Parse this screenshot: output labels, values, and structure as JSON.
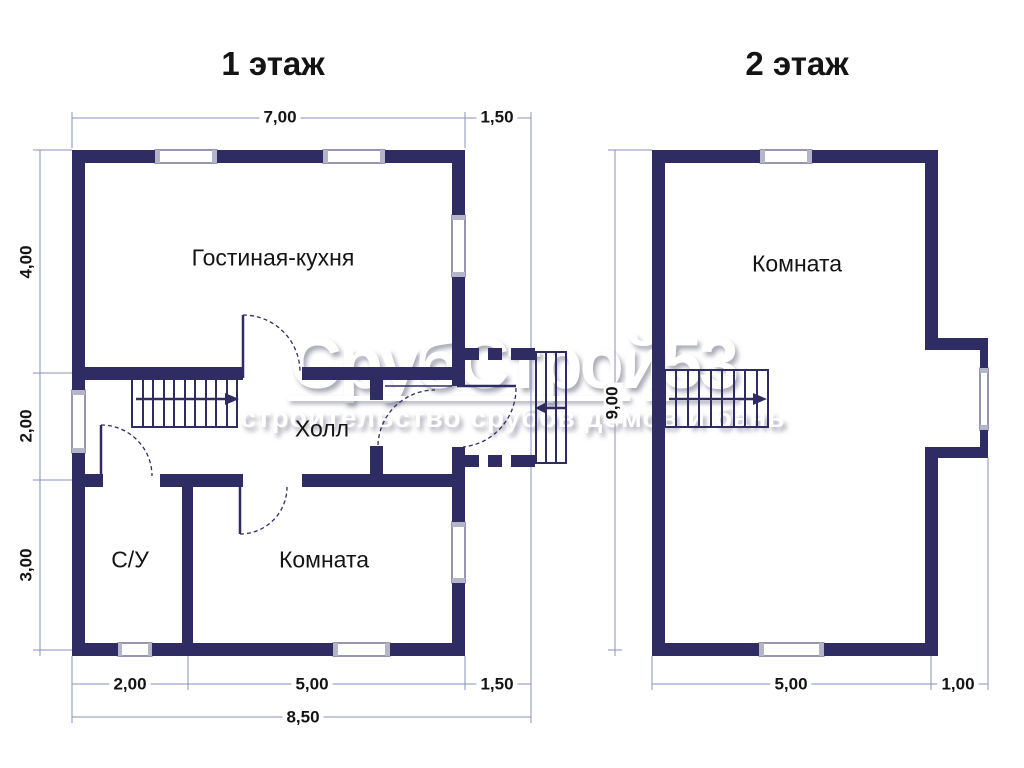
{
  "colors": {
    "wall": "#2f2b63",
    "dim": "#8a90bd",
    "text": "#141414",
    "window_cap": "#b5b5c8",
    "watermark": "#ffffff"
  },
  "floor1": {
    "title": "1 этаж",
    "rooms": {
      "living": "Гостиная-кухня",
      "hall": "Холл",
      "bathroom": "С/У",
      "room": "Комната"
    },
    "dims": {
      "top_main": "7,00",
      "top_porch": "1,50",
      "left_top": "4,00",
      "left_mid": "2,00",
      "left_bottom": "3,00",
      "bottom_left": "2,00",
      "bottom_mid": "5,00",
      "bottom_right": "1,50",
      "bottom_total": "8,50"
    }
  },
  "floor2": {
    "title": "2 этаж",
    "rooms": {
      "room": "Комната"
    },
    "dims": {
      "height": "9,00",
      "bottom_main": "5,00",
      "bottom_right": "1,00"
    }
  },
  "watermark": {
    "brand": "СрубСтрой53",
    "tagline": "строительство срубов домов и бань"
  }
}
